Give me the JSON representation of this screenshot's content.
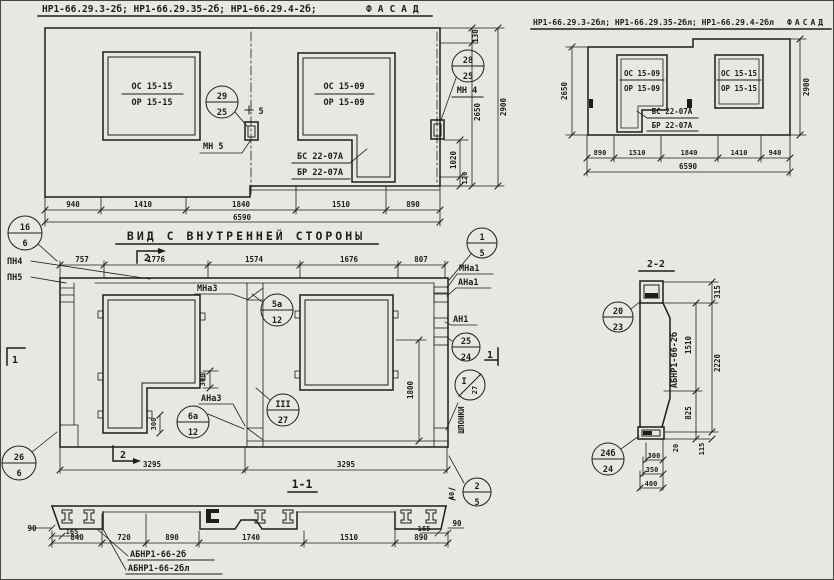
{
  "colors": {
    "paper": "#e9e7e1",
    "ink": "#1d1d1b"
  },
  "facade_left": {
    "title_ids": "НР1-66.29.3-2б; НР1-66.29.35-2б; НР1-66.29.4-2б;",
    "title_view": "ФАСАД",
    "win1_num": "ОС 15-15",
    "win1_den": "ОР 15-15",
    "win2_num": "ОС 15-09",
    "win2_den": "ОР 15-09",
    "balc_num": "БС 22-07А",
    "balc_den": "БР 22-07А",
    "call1_num": "29",
    "call1_den": "25",
    "call2_num": "28",
    "call2_den": "25",
    "mn5": "МН 5",
    "mn4": "МН 4",
    "weld": "5",
    "dim_130": "130",
    "dim_2650": "2650",
    "dim_2900": "2900",
    "dim_1020": "1020",
    "dim_120": "120",
    "dims_bottom": [
      "940",
      "1410",
      "1840",
      "1510",
      "890"
    ],
    "dim_total": "6590"
  },
  "facade_right": {
    "title_ids": "НР1-66.29.3-2бл; НР1-66.29.35-2бл; НР1-66.29.4-2бл",
    "title_view": "ФАСАД",
    "win1_num": "ОС 15-09",
    "win1_den": "ОР 15-09",
    "win2_num": "ОС 15-15",
    "win2_den": "ОР 15-15",
    "balc_num": "БС 22-07А",
    "balc_den": "БР 22-07А",
    "dim_2650": "2650",
    "dim_2900": "2900",
    "dims_bottom": [
      "890",
      "1510",
      "1840",
      "1410",
      "940"
    ],
    "dim_total": "6590"
  },
  "inner_view": {
    "title": "ВИД С ВНУТРЕННЕЙ СТОРОНЫ",
    "call_16_num": "16",
    "call_16_den": "6",
    "pn4": "ПН4",
    "pn5": "ПН5",
    "dims_top": [
      "757",
      "1776",
      "1574",
      "1676",
      "807"
    ],
    "sec_mark_2": "2",
    "sec_mark_1": "1",
    "mna3": "МНа3",
    "ana3": "АНа3",
    "mna1": "МНа1",
    "ana1": "АНа1",
    "an1": "АН1",
    "call_5a_num": "5а",
    "call_5a_den": "12",
    "call_6a_num": "6а",
    "call_6a_den": "12",
    "call_III_num": "III",
    "call_III_den": "27",
    "call_1_num": "1",
    "call_1_den": "5",
    "call_25_num": "25",
    "call_25_den": "24",
    "call_I_num": "I",
    "call_I_den": "27",
    "shponki": "ШПОНКИ",
    "dim_300a": "300",
    "dim_300b": "300",
    "dim_1800": "1800",
    "dim_40": "40",
    "dims_bottom": [
      "3295",
      "3295"
    ],
    "call_26_num": "26",
    "call_26_den": "6",
    "call_2_num": "2",
    "call_2_den": "5"
  },
  "section_1_1": {
    "title": "1-1",
    "dim_90_left": "90",
    "dim_90_right": "90",
    "dim_165_left": "165",
    "dim_165_right": "165",
    "dims": [
      "840",
      "720",
      "890",
      "1740",
      "1510",
      "890"
    ],
    "label_a": "АБНР1-66-2б",
    "label_b": "АБНР1-66-2бл"
  },
  "section_2_2": {
    "title": "2-2",
    "call_20_num": "20",
    "call_20_den": "23",
    "call_24_num": "24б",
    "call_24_den": "24",
    "vlabel": "АБНР1-66-2б",
    "dim_315": "315",
    "dim_1510": "1510",
    "dim_2220": "2220",
    "dim_825": "825",
    "dim_20": "20",
    "dim_115": "115",
    "dim_300": "300",
    "dim_350": "350",
    "dim_400": "400"
  }
}
